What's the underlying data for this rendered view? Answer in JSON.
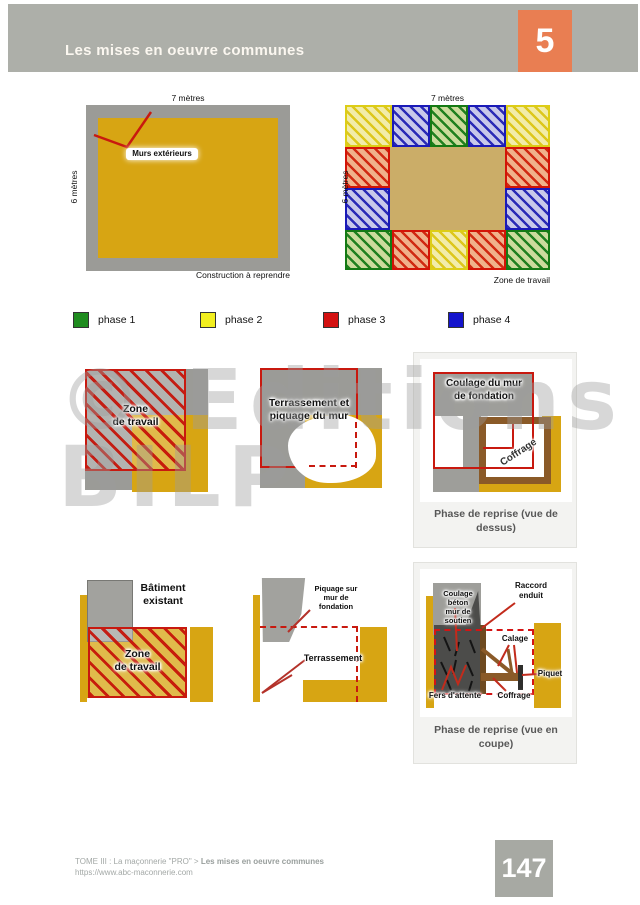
{
  "header": {
    "title": "Les mises en oeuvre communes",
    "chapter": "5"
  },
  "existing_plan": {
    "width_label": "7 mètres",
    "height_label": "6 mètres",
    "wall_label": "Murs extérieurs",
    "caption": "Construction à reprendre"
  },
  "phased_plan": {
    "width_label": "7 mètres",
    "height_label": "6 mètres",
    "caption": "Zone de travail",
    "top_row": [
      "phase 2",
      "phase 4",
      "phase 1",
      "phase 4",
      "phase 2"
    ],
    "left_side": [
      "phase 3",
      "phase 4"
    ],
    "right_side": [
      "phase 3",
      "phase 4"
    ],
    "bottom_row": [
      "phase 1",
      "phase 3",
      "phase 2",
      "phase 3",
      "phase 1"
    ]
  },
  "legend": {
    "items": [
      {
        "label": "phase 1",
        "color": "#1f8c1f"
      },
      {
        "label": "phase 2",
        "color": "#f2ee1e"
      },
      {
        "label": "phase 3",
        "color": "#d31111"
      },
      {
        "label": "phase 4",
        "color": "#1414cc"
      }
    ]
  },
  "fig_zone_travail": {
    "label": "Zone\nde travail"
  },
  "fig_terrassement": {
    "label": "Terrassement et\npiquage du mur"
  },
  "fig_coulage": {
    "label": "Coulage du mur\nde fondation",
    "coffrage_label": "Coffrage",
    "caption": "Phase de reprise (vue de\ndessus)"
  },
  "fig_batiment": {
    "building_label": "Bâtiment\nexistant",
    "zone_label": "Zone\nde travail"
  },
  "fig_piquage": {
    "piquage_label": "Piquage sur\nmur de\nfondation",
    "terrassement_label": "Terrassement"
  },
  "fig_coupe": {
    "coulage_label": "Coulage\nbéton\nmur de\nsoutien",
    "raccord_label": "Raccord\nenduit",
    "calage_label": "Calage",
    "piquet_label": "Piquet",
    "fers_label": "Fers d'attente",
    "coffrage_label": "Coffrage",
    "caption": "Phase de reprise (vue en\ncoupe)"
  },
  "watermark": {
    "line1": "© Editions",
    "line2": "BILP"
  },
  "footer": {
    "breadcrumb": "TOME III : La maçonnerie \"PRO\" > ",
    "breadcrumb_bold": "Les mises en oeuvre communes",
    "url": "https://www.abc-maconnerie.com",
    "page_number": "147"
  }
}
